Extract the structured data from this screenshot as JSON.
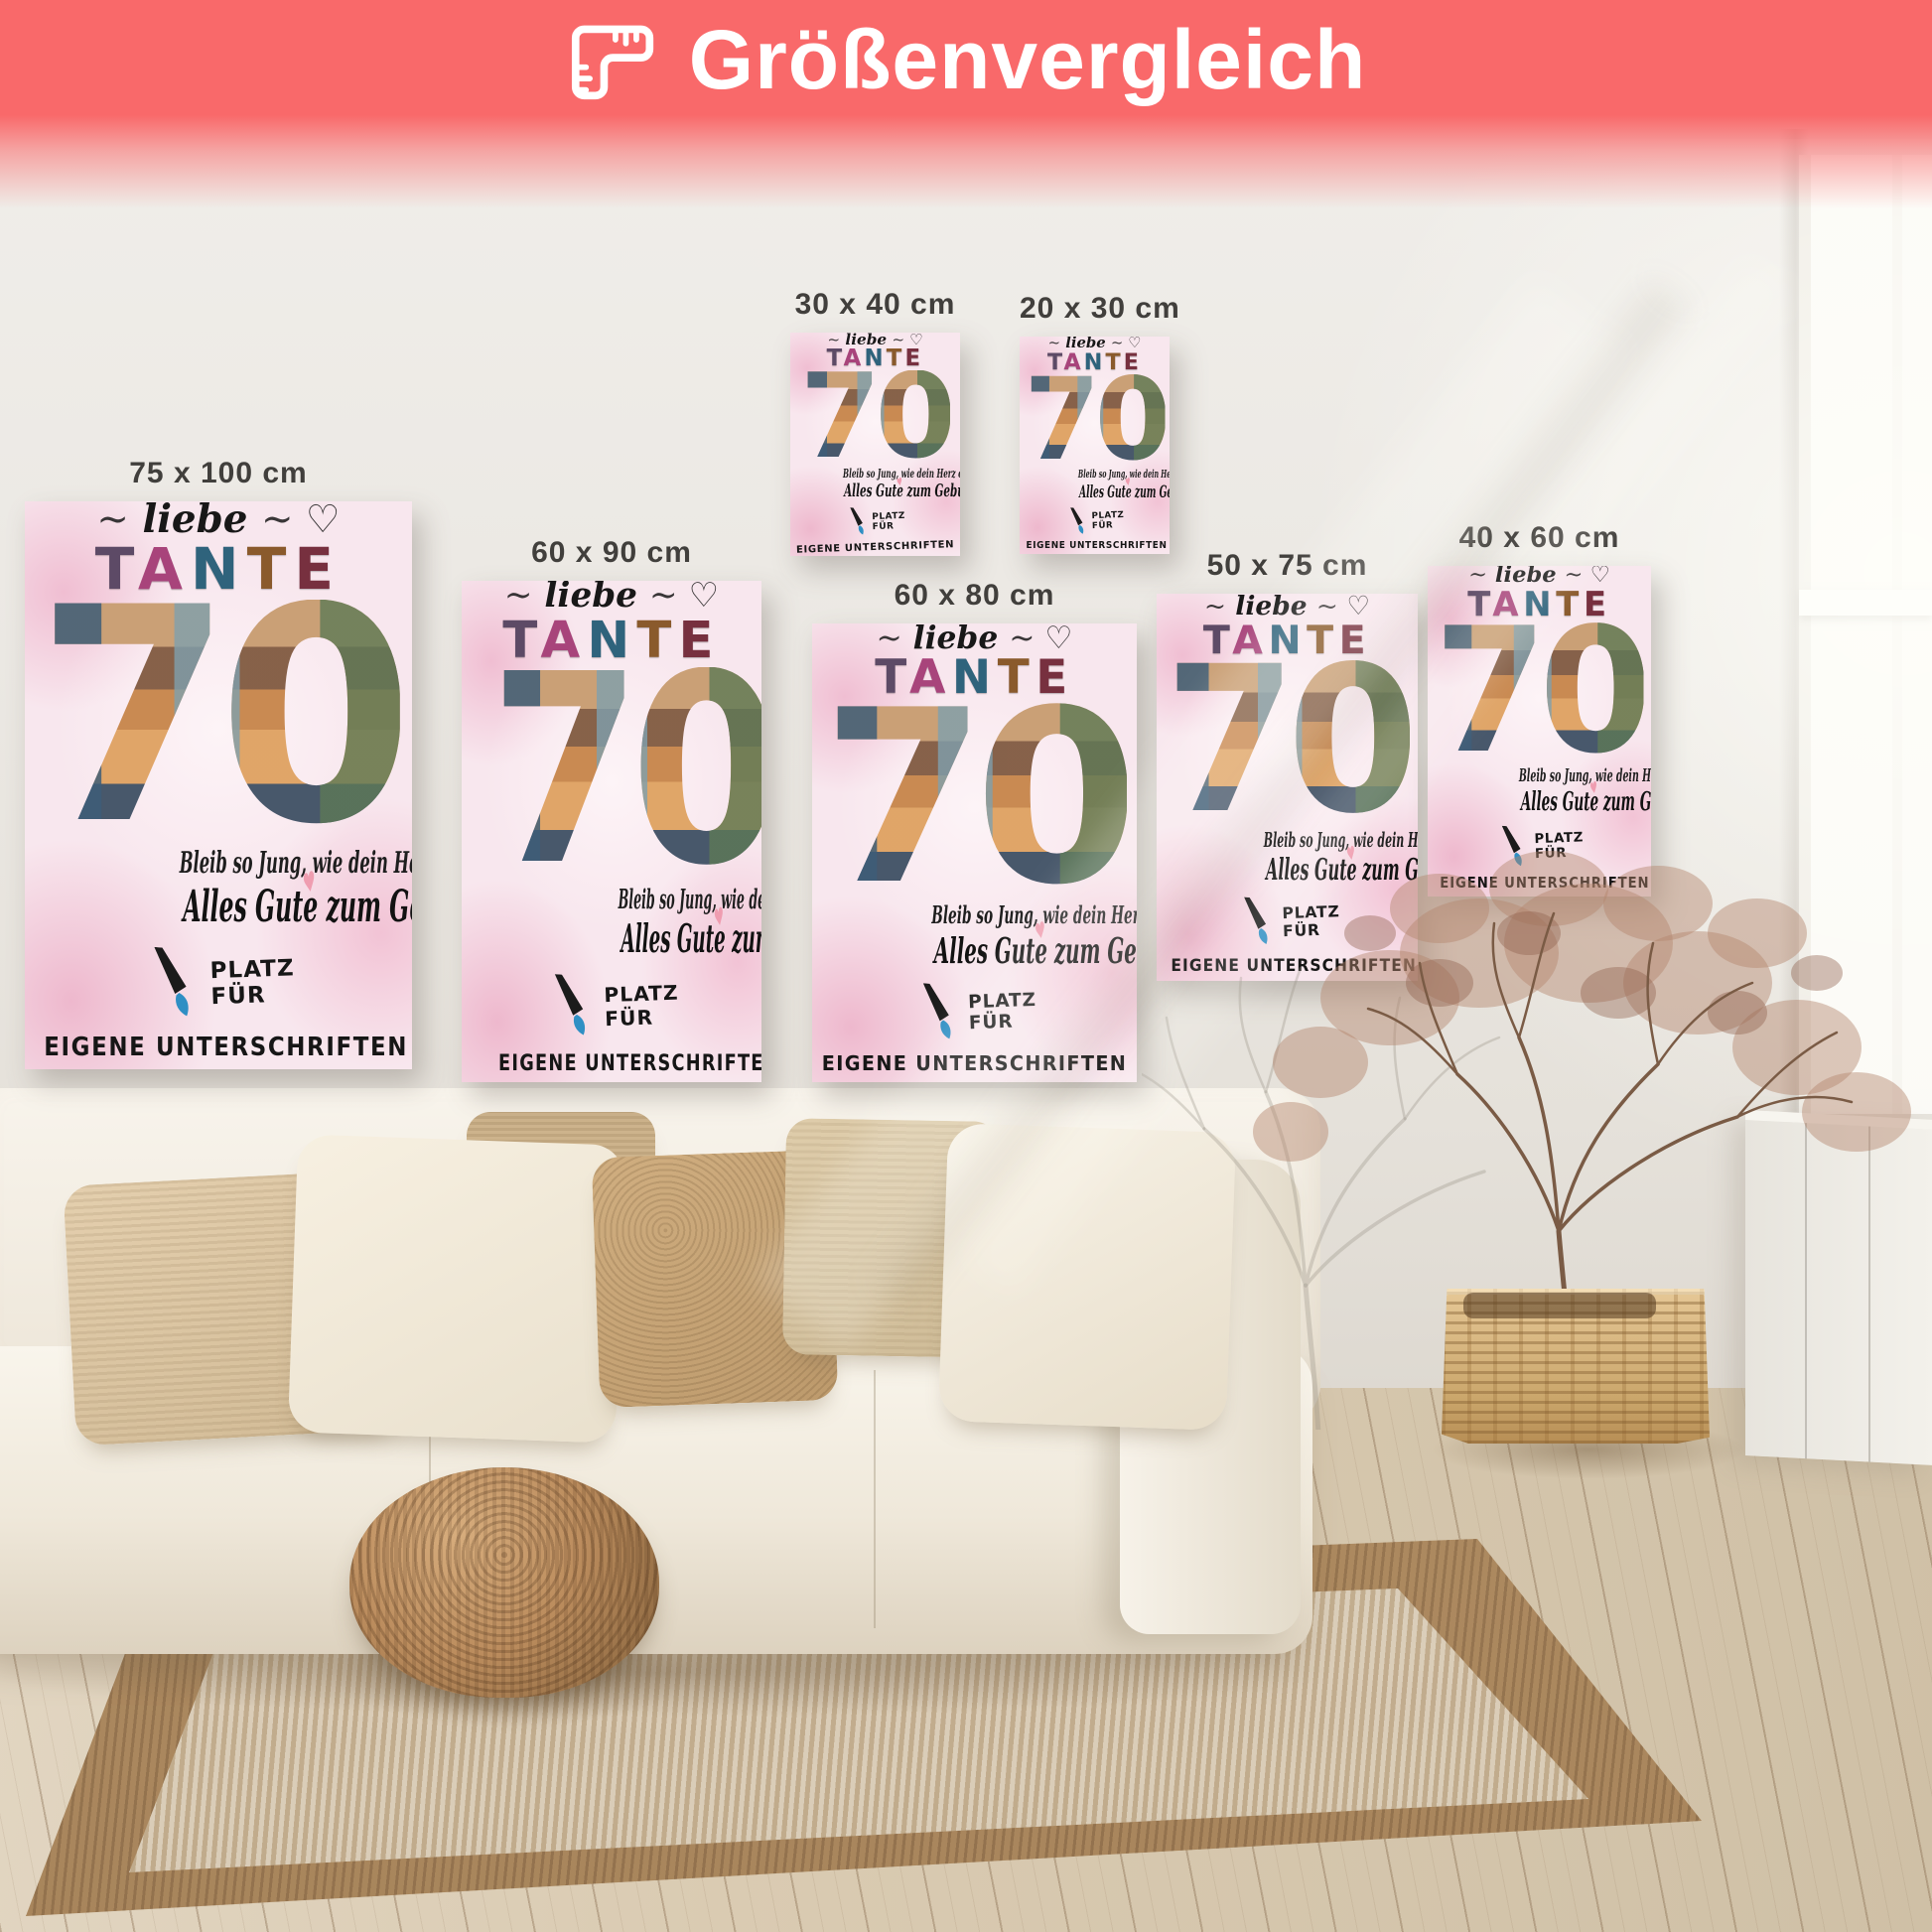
{
  "banner": {
    "title": "Größenvergleich",
    "icon": "ruler-icon",
    "background_color": "#f9696a",
    "text_color": "#ffffff"
  },
  "posters": [
    {
      "label": "75 x 100 cm"
    },
    {
      "label": "60 x 90 cm"
    },
    {
      "label": "30 x 40 cm"
    },
    {
      "label": "20 x 30 cm"
    },
    {
      "label": "60 x 80 cm"
    },
    {
      "label": "50 x 75 cm"
    },
    {
      "label": "40 x 60 cm"
    }
  ],
  "poster_content": {
    "decor_left": "~",
    "script_word": "liebe",
    "decor_right": "~ ♡",
    "headline": "TANTE",
    "headline_letter_colors": [
      "#5d4a66",
      "#a8447b",
      "#2f637c",
      "#8a5a2c",
      "#77303f"
    ],
    "big_number": "70",
    "line1": "Bleib so Jung, wie dein Herz es dir sagt.",
    "heart_icon": "♥",
    "heart_color": "#ef9db0",
    "line2": "Alles Gute zum Geburtstag!",
    "signature_line1": "PLATZ FÜR",
    "signature_line2": "EIGENE UNTERSCHRIFTEN",
    "background_pink": "#f8e7ee"
  }
}
